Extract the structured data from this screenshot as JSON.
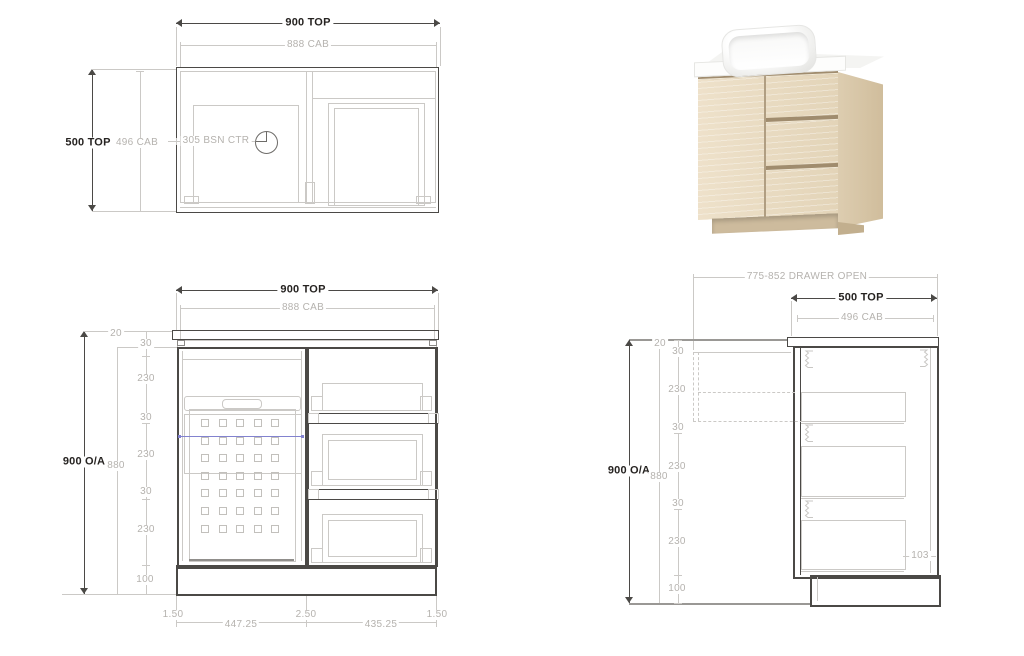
{
  "colors": {
    "line_dark": "#4b4946",
    "line_light": "#cbc9c6",
    "text_dark": "#262321",
    "text_light": "#b5b2ae",
    "blue": "#8282cf",
    "wood_face": "#e9dcc4",
    "wood_side": "#d8c7a9",
    "wood_kick": "#cdbb9d"
  },
  "top_view": {
    "dim_900_top": "900 TOP",
    "dim_888_cab": "888 CAB",
    "dim_500_top": "500 TOP",
    "dim_496_cab": "496 CAB",
    "dim_basin_center": "305 BSN CTR"
  },
  "front_view": {
    "dim_900_top": "900 TOP",
    "dim_888_cab": "888 CAB",
    "dim_900_oa": "900 O/A",
    "dim_880": "880",
    "dim_20": "20",
    "chain": [
      "30",
      "230",
      "30",
      "230",
      "30",
      "230",
      "100"
    ],
    "bottom": [
      "1.50",
      "447.25",
      "2.50",
      "435.25",
      "1.50"
    ]
  },
  "side_view": {
    "dim_drawer_open": "775-852 DRAWER OPEN",
    "dim_500_top": "500 TOP",
    "dim_496_cab": "496 CAB",
    "dim_900_oa": "900 O/A",
    "dim_880": "880",
    "dim_20": "20",
    "dim_103": "103",
    "chain": [
      "30",
      "230",
      "30",
      "230",
      "30",
      "230",
      "100"
    ]
  }
}
